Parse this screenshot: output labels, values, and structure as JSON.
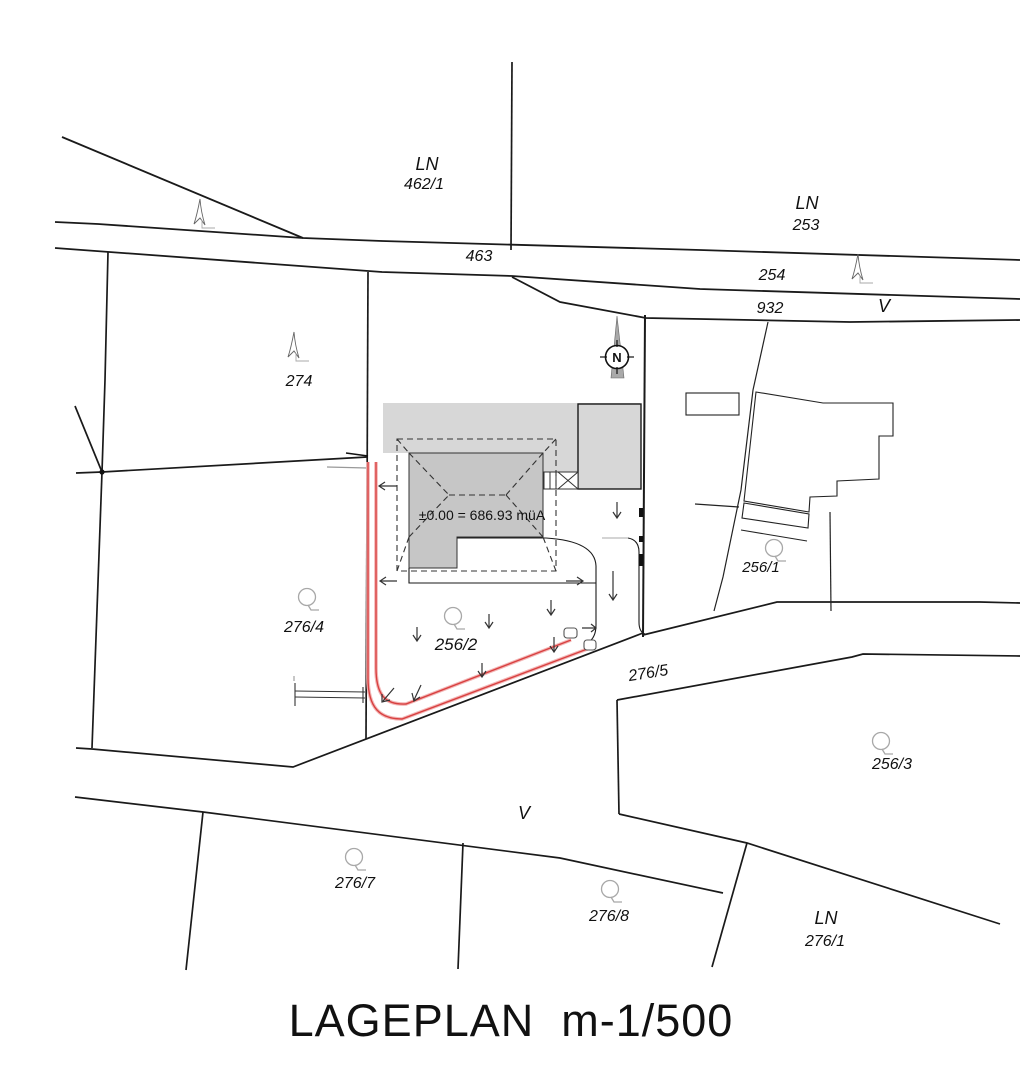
{
  "title": "LAGEPLAN  m-1/500",
  "building": {
    "elevation_note": "±0.00 = 686.93 müA"
  },
  "north_arrow": {
    "label": "N"
  },
  "road_labels": {
    "top_left_num": "463",
    "mid_num": "254",
    "lower_num": "932",
    "right_letter": "V",
    "bottom_letter": "V"
  },
  "parcels": {
    "ln462": {
      "type": "LN",
      "number": "462/1"
    },
    "ln253": {
      "type": "LN",
      "number": "253"
    },
    "p274": "274",
    "p276_4": "276/4",
    "p256_2": "256/2",
    "p256_1": "256/1",
    "p276_5": "276/5",
    "p256_3": "256/3",
    "p276_7": "276/7",
    "p276_8": "276/8",
    "ln276_1": {
      "type": "LN",
      "number": "276/1"
    }
  },
  "colors": {
    "driveway_red": "#d84040",
    "driveway_red_light": "#f3b6b6",
    "terrace_gray": "#d7d7d7",
    "building_gray": "#c6c6c6",
    "line_black": "#1a1a1a",
    "tree_gray": "#a8a8a8"
  }
}
